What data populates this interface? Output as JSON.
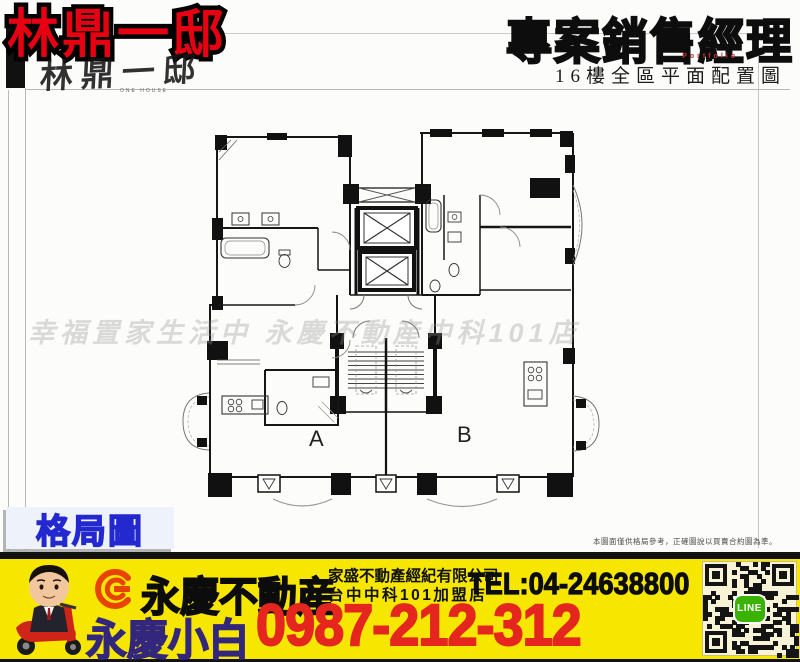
{
  "header": {
    "title": "林鼎一邸",
    "logo_text": "林鼎一邸",
    "logo_subtext": "ONE HOUSE",
    "right_title": "專案銷售經理",
    "right_subtitle": "Portfolio",
    "plan_caption": "16樓全區平面配置圖"
  },
  "plan": {
    "unit_a_label": "A",
    "unit_b_label": "B",
    "watermark": "幸福置家生活中 永慶不動産中科101店",
    "disclaimer": "本圖面僅供格局參考，正確圖說以買賣合約圖為準。",
    "badge_label": "格局圖"
  },
  "footer": {
    "brand": "永慶不動産",
    "company_line1": "家盛不動產經紀有限公司",
    "company_line2": "台中中科101加盟店",
    "tel": "TEL:04-24638800",
    "agent_name": "永慶小白",
    "mobile": "0987-212-312",
    "qr_label": "LINE"
  },
  "colors": {
    "title_red": "#e60012",
    "badge_blue": "#2428cf",
    "footer_yellow": "#f6e600",
    "phone_red": "#e5261e",
    "agent_navy": "#33277d",
    "logo_orange": "#e84300",
    "line_green": "#3ab300"
  }
}
